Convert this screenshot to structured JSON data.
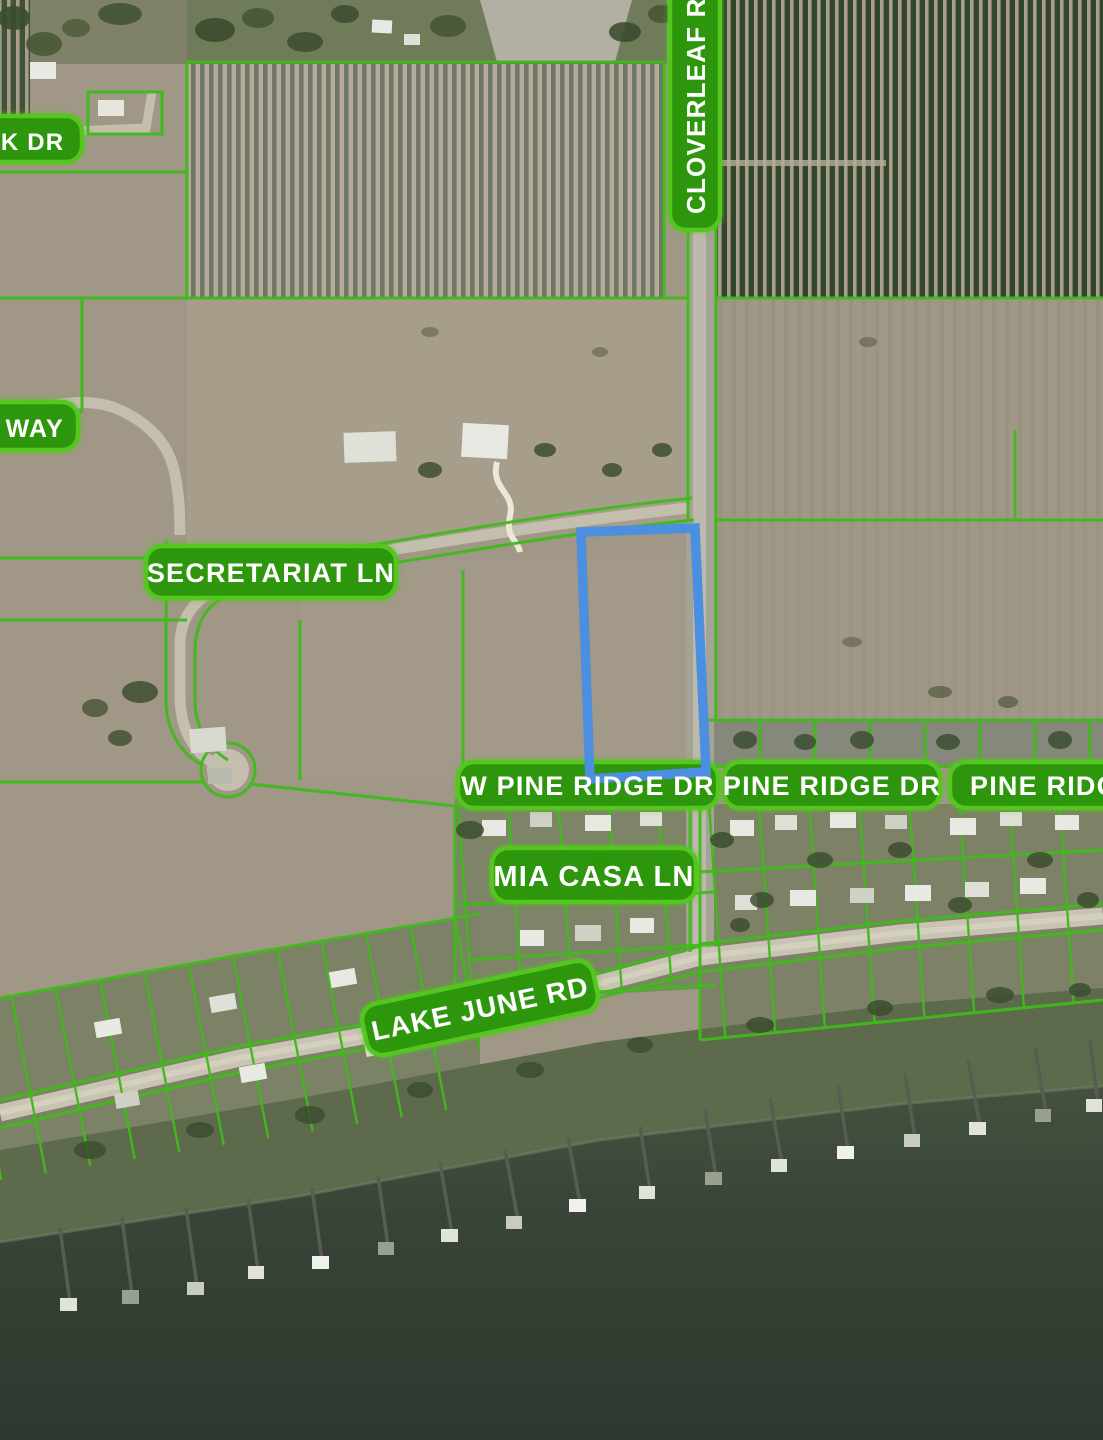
{
  "map": {
    "title": "Aerial parcel map with selected parcel highlight",
    "selected_parcel": {
      "outline_color": "#4a8fe0",
      "location": "west of Cloverleaf Rd between Secretariat Ln and W Pine Ridge Dr"
    },
    "style": {
      "parcel_line_color": "#3fba19",
      "label_fill_color": "#2c950c",
      "label_border_color": "#54c81e",
      "label_text_color": "#ffffff",
      "water_color": "#38443a",
      "road_color": "#c4beae",
      "land_color": "#a09786"
    },
    "labels": {
      "creek_dr_partial": "EK DR",
      "cloverleaf_rd": "CLOVERLEAF RD",
      "way_partial": "D WAY",
      "secretariat_ln": "SECRETARIAT LN",
      "w_pine_ridge_dr": "W PINE RIDGE DR",
      "pine_ridge_dr": "PINE RIDGE DR",
      "pine_ridge_dr_partial": "PINE RIDGE",
      "mia_casa_ln": "MIA CASA LN",
      "lake_june_rd": "LAKE JUNE RD"
    }
  }
}
